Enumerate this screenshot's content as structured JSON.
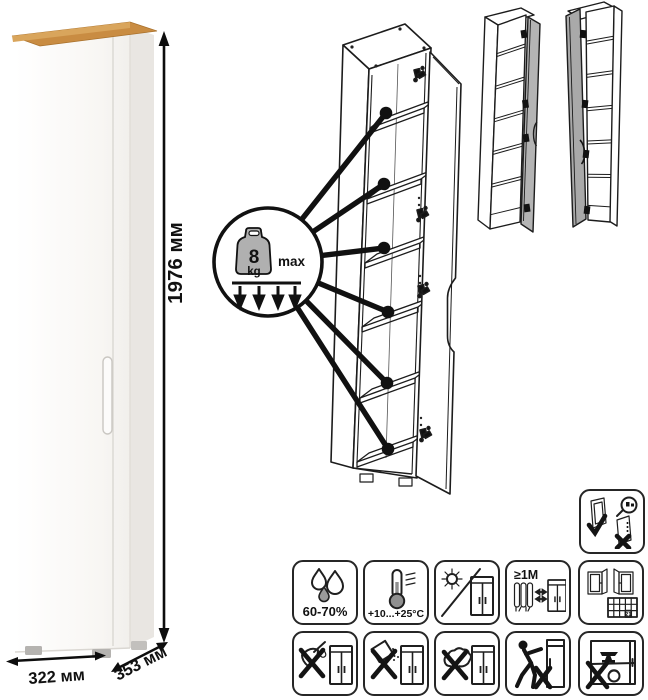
{
  "dimensions": {
    "height": "1976 мм",
    "width": "322 мм",
    "depth": "353 мм"
  },
  "shelf_load": {
    "value": "8",
    "unit": "kg",
    "qualifier": "max"
  },
  "pictograms": {
    "humidity_range": "60-70%",
    "temperature_range": "+10...+25°C",
    "heat_distance": "≥1М",
    "ventilation_day": "21",
    "names": {
      "adjust": "hinge-adjustment",
      "humidity": "humidity-60-70",
      "temperature": "temperature-range",
      "sunlight": "avoid-direct-sunlight",
      "distance": "keep-1m-from-heat",
      "ventilation": "ventilate-room",
      "sharp": "no-sharp-tools",
      "abrasive": "no-abrasive-cleaners",
      "sponge": "no-wet-cleaning",
      "push": "do-not-push-doors",
      "overload": "do-not-overload"
    }
  },
  "colors": {
    "wood_top": "#c98c42",
    "side_shade": "#e9e6e2",
    "door_gray": "#b4b4b4",
    "line": "#1c1c1c"
  }
}
